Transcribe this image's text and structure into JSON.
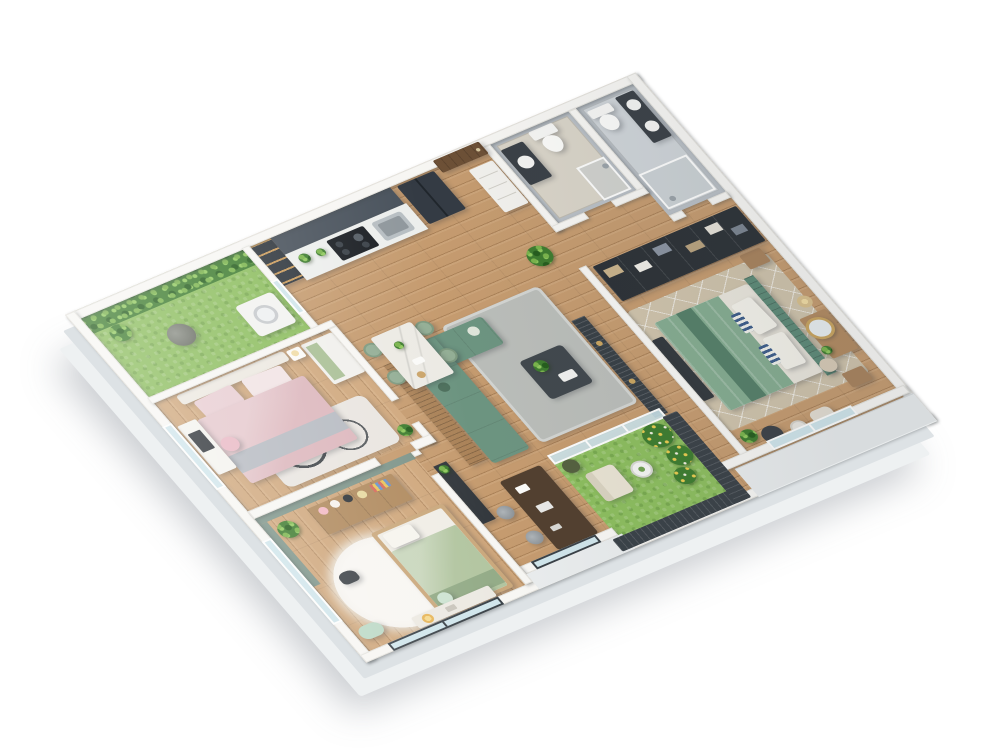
{
  "scene": {
    "title": "3D isometric apartment floor plan render",
    "view": "bird's-eye isometric, white background, light grey floor slab",
    "palette": {
      "background": "#ffffff",
      "floor_slab": "#dde2e5",
      "walls": "#f7f6f3",
      "wood_floor": "#c59b6f",
      "wood_floor_bedrooms": "#cfa77c",
      "grass": "#8cbd5e",
      "foliage_green": "#3e7c2f",
      "kitchen_cabinets_charcoal": "#49525c",
      "countertop_white": "#eceeec",
      "sofa_green": "#6c9480",
      "living_rug_grey": "#babdb9",
      "master_bed_green": "#85ac90",
      "headboard_green": "#5d8a77",
      "master_rug_beige": "#cfc3ab",
      "wardrobe_dark": "#2c3136",
      "bed_pink": "#dcb6bc",
      "kids_bed_sage": "#b2c5a0",
      "kids_accent_wall": "#7e958a",
      "bathroom_stone": "#b9bfc5",
      "railing_dark": "#3a4147",
      "dining_marble": "#eceae4",
      "dining_chair_green": "#93ae95",
      "bar_counter_brown": "#52402f"
    },
    "rooms": [
      {
        "id": "laundry-balcony",
        "name": "Laundry balcony with vertical garden",
        "items": [
          "vertical garden green wall",
          "artificial grass floor",
          "washing machine",
          "rattan planter basket",
          "glass door to kitchen"
        ]
      },
      {
        "id": "kitchen",
        "name": "Kitchen",
        "items": [
          "display cabinet with lit shelves",
          "charcoal cabinet run",
          "white stone countertop",
          "black cooktop",
          "sink with mixer tap",
          "counter plants",
          "refrigerator"
        ]
      },
      {
        "id": "entry",
        "name": "Entry hall",
        "items": [
          "timber entrance door",
          "shoe / display cabinet",
          "potted plant"
        ]
      },
      {
        "id": "bathroom-1",
        "name": "Guest bathroom",
        "items": [
          "dark vanity with basin",
          "toilet",
          "walk-in shower",
          "grey stone-clad walls"
        ]
      },
      {
        "id": "bathroom-2",
        "name": "Ensuite bathroom",
        "items": [
          "double-basin vanity",
          "toilet",
          "walk-in shower",
          "grey stone-clad walls"
        ]
      },
      {
        "id": "walk-in-wardrobe",
        "name": "Walk-in wardrobe",
        "items": [
          "open dark shelving filled with clothing and boxes"
        ]
      },
      {
        "id": "master-bedroom",
        "name": "Master bedroom",
        "items": [
          "double bed with green bedding",
          "slatted green headboard with striped pillows",
          "media bench",
          "bedside tables",
          "dressing table with round gold mirror",
          "vanity stool",
          "floor lamp",
          "diamond-pattern beige rug",
          "grey pouf",
          "round side table",
          "cream accent chair",
          "potted plant",
          "full-height window"
        ]
      },
      {
        "id": "living-room",
        "name": "Living room",
        "items": [
          "L-shaped green fabric sofa",
          "scatter cushions",
          "grey shaggy rug",
          "dark coffee table with plant and tray",
          "timber slatted screen behind sofa",
          "dark slatted TV feature wall",
          "media cabinet with plant",
          "hallway potted plant"
        ]
      },
      {
        "id": "dining-area",
        "name": "Dining area",
        "items": [
          "white marble dining table",
          "four sage upholstered chairs",
          "vase, plates and bowl"
        ]
      },
      {
        "id": "bar",
        "name": "Bar counter",
        "items": [
          "dark timber bar counter",
          "two grey bar stools",
          "bar-top accessories",
          "dark-framed window"
        ]
      },
      {
        "id": "main-balcony",
        "name": "Main balcony garden",
        "items": [
          "artificial grass floor",
          "cream lounge chair",
          "round white coffee table",
          "flowering shrubs",
          "planter",
          "dark balustrade",
          "sliding glass door"
        ]
      },
      {
        "id": "bedroom-2",
        "name": "Second bedroom",
        "items": [
          "double bed with blush bedding and grey throw",
          "upholstered headboard",
          "white desk with dark mirror",
          "pink chair",
          "wardrobe with sage insert",
          "bedside table with lamp",
          "ivory rug with dark ring motif",
          "potted plant",
          "full-height windows"
        ]
      },
      {
        "id": "kids-bedroom",
        "name": "Kids bedroom",
        "items": [
          "sage accent walls",
          "toy shelf with plush toys and books",
          "single bed with sage bedding",
          "round fluffy white rug",
          "dark rocking toy",
          "mint bench seat",
          "desk with warm lamp",
          "potted plant",
          "window"
        ]
      }
    ]
  }
}
